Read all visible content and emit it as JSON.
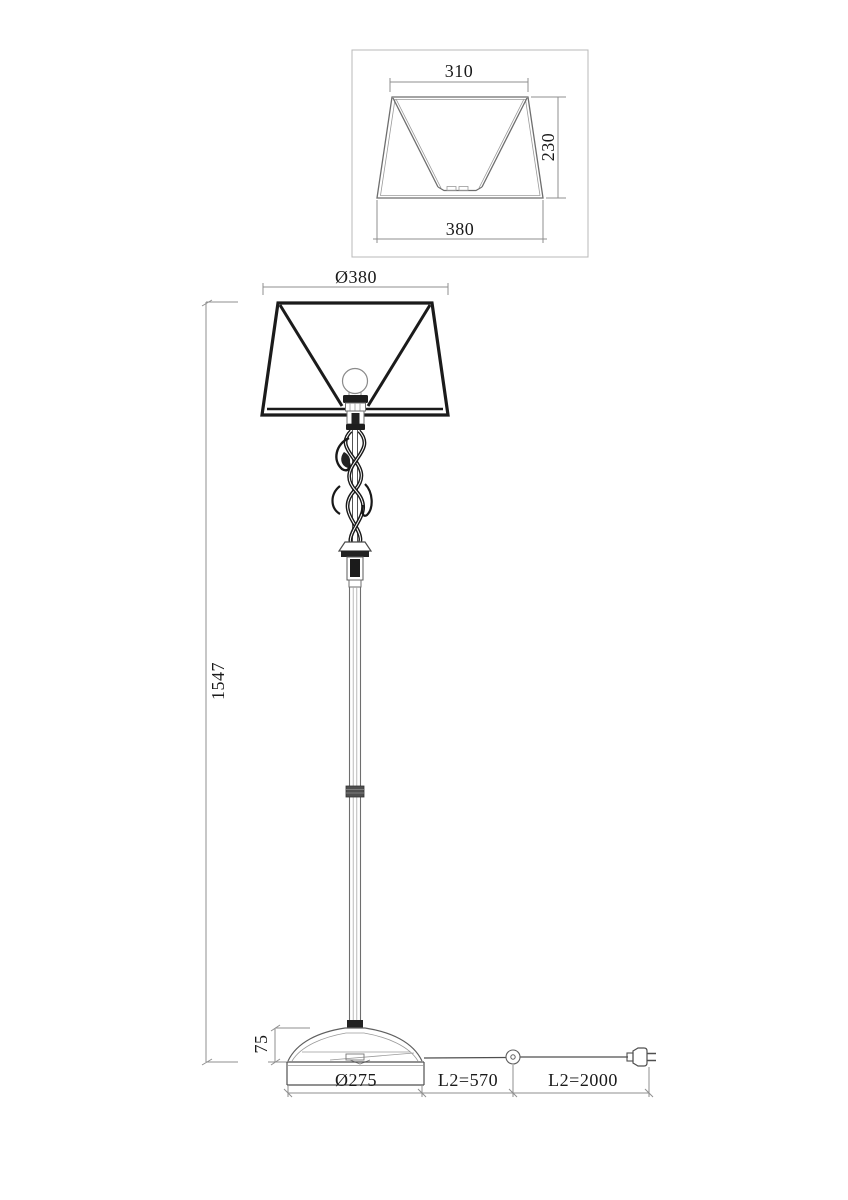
{
  "drawing": {
    "detail_view": {
      "top_width_label": "310",
      "side_height_label": "230",
      "bottom_width_label": "380"
    },
    "main_view": {
      "shade_diameter_label": "Ø380",
      "overall_height_label": "1547",
      "base_height_label": "75",
      "base_diameter_label": "Ø275",
      "cord_switch_segment_label": "L2=570",
      "cord_plug_segment_label": "L2=2000"
    }
  },
  "colors": {
    "background": "#ffffff",
    "thick_line": "#1b1b1b",
    "thin_line": "#787878",
    "dim_line": "#9a9a9a",
    "text": "#1a1a1a",
    "detail_box_border": "#b8b8b8"
  }
}
